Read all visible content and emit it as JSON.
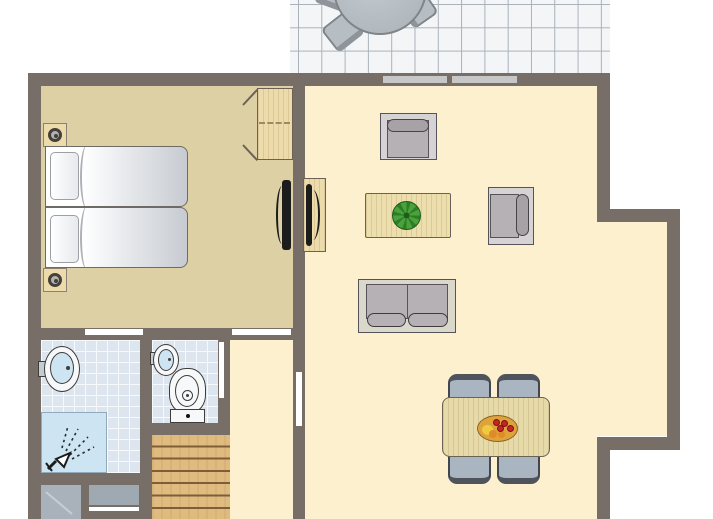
{
  "title": "holiday-home-floor-plan",
  "colors": {
    "wall": "#776e68",
    "bedroomFloor": "#ddd0a4",
    "livingFloor": "#fcf0ce",
    "tile": "#dde6ee",
    "tileLine": "#f6fafc",
    "showerBlue": "#cde4f2",
    "patioTile": "#f3f5f7",
    "patioLine": "#a9b2bb",
    "patioFurn": "#b7bec3",
    "patioFurnBorder": "#7f8487",
    "wood": "#eddcab",
    "woodEdge": "#6b6255",
    "stairWood": "#dfbb80",
    "stairLine": "#7f5d36",
    "glassBar": "#c7c7c7",
    "sofaShell": "#d5d3d4",
    "sofaSeat": "#b6b1b4",
    "cushion": "#a7a2a5",
    "furnBorder": "#56535a",
    "chairBlue": "#a9b6c2",
    "chairDark": "#42464e",
    "fixtureLine": "#3f3c39",
    "tvBlack": "#1c1c1c",
    "plantGreen": "#4aa23b",
    "plantDark": "#2e7d28",
    "bowl": "#dfa33c",
    "fruitRed": "#c42525",
    "fruitYellow": "#efc93f",
    "fruitOrange": "#df8b28",
    "applianceA": "#a9b2ba",
    "applianceB": "#9ea9b2"
  },
  "rooms": [
    {
      "name": "terrace"
    },
    {
      "name": "bedroom"
    },
    {
      "name": "living-room"
    },
    {
      "name": "bathroom"
    },
    {
      "name": "toilet"
    },
    {
      "name": "hallway"
    },
    {
      "name": "stairs"
    },
    {
      "name": "storage"
    }
  ],
  "furniture": [
    {
      "name": "patio-table"
    },
    {
      "name": "patio-chair"
    },
    {
      "name": "double-bed"
    },
    {
      "name": "nightstand-lamp"
    },
    {
      "name": "wardrobe"
    },
    {
      "name": "tv-bedroom"
    },
    {
      "name": "tv-living"
    },
    {
      "name": "armchair"
    },
    {
      "name": "coffee-table"
    },
    {
      "name": "plant"
    },
    {
      "name": "side-chair"
    },
    {
      "name": "sofa"
    },
    {
      "name": "dining-table"
    },
    {
      "name": "dining-chair"
    },
    {
      "name": "fruit-bowl"
    },
    {
      "name": "washbasin"
    },
    {
      "name": "shower"
    },
    {
      "name": "toilet-bowl"
    },
    {
      "name": "appliance"
    }
  ]
}
